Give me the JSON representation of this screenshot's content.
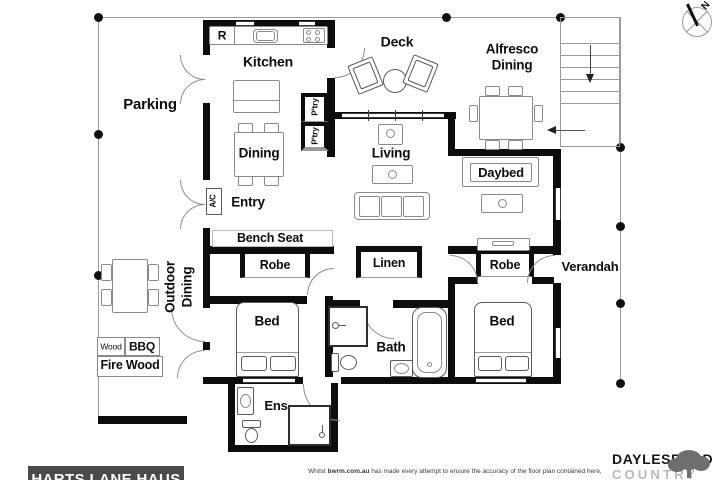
{
  "labels": {
    "parking": "Parking",
    "kitchen": "Kitchen",
    "fridge": "R",
    "dining": "Dining",
    "pantry": "P'try",
    "deck": "Deck",
    "alfresco_line1": "Alfresco",
    "alfresco_line2": "Dining",
    "living": "Living",
    "daybed": "Daybed",
    "ac": "A/C",
    "entry": "Entry",
    "bench_seat": "Bench Seat",
    "robe": "Robe",
    "linen": "Linen",
    "verandah": "Verandah",
    "outdoor_line1": "Outdoor",
    "outdoor_line2": "Dining",
    "wood": "Wood",
    "bbq": "BBQ",
    "fire_wood": "Fire Wood",
    "bed": "Bed",
    "bath": "Bath",
    "ens": "Ens",
    "north": "N"
  },
  "footer": {
    "plan_title": "HARTS LANE HAUS",
    "disclaimer_prefix": "Whilst ",
    "disclaimer_site": "bwrm.com.au",
    "disclaimer_rest": " has made every attempt to ensure the accuracy of the floor plan contained here,",
    "brand_name": "DAYLESFORD",
    "brand_subtitle": "COUNTRY"
  },
  "colors": {
    "wall": "#0d0d0d",
    "banner": "#4a4a4a",
    "boundary": "#9a9a9a",
    "brand_gray": "#6e6e6e"
  }
}
